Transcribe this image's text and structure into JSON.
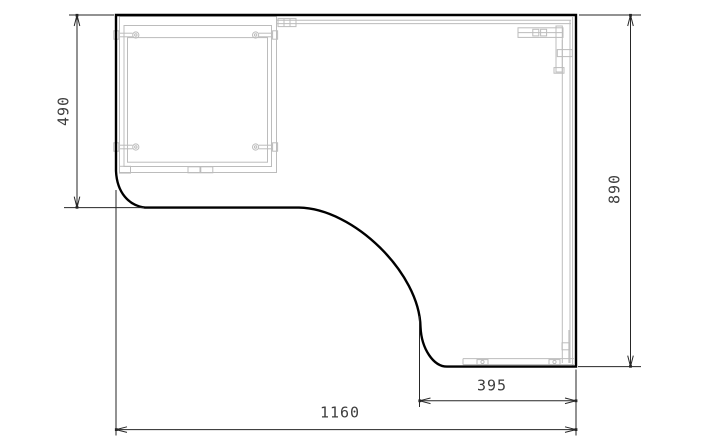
{
  "drawing": {
    "dimension_labels": {
      "left_depth": "490",
      "right_height": "890",
      "corner_return_width": "395",
      "overall_width": "1160"
    },
    "colors": {
      "background": "#ffffff",
      "outline": "#000000",
      "hardware_detail": "#bcbcbc",
      "dimension_line": "#262626",
      "dimension_text": "#3d3d3d"
    }
  }
}
